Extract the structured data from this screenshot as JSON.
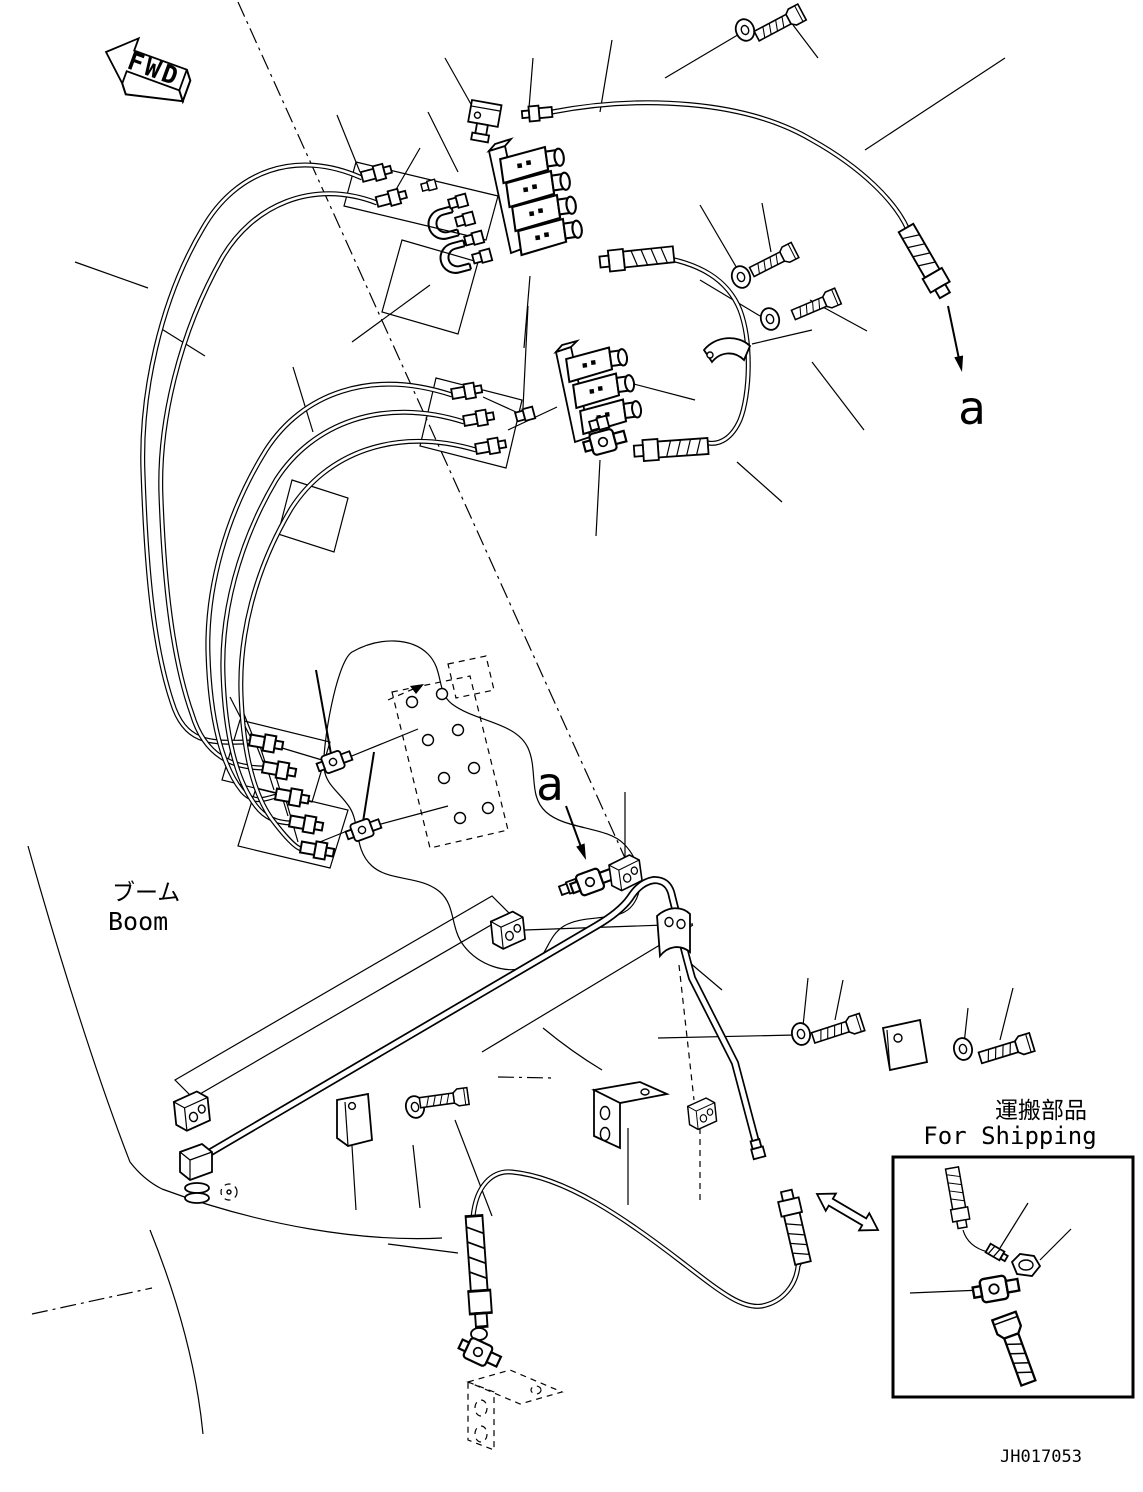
{
  "drawing": {
    "background_color": "#ffffff",
    "ink_color": "#000000",
    "fwd_label": "FWD",
    "section_marker_top": "a",
    "section_marker_mid": "a",
    "boom_label_jp": "ブーム",
    "boom_label_en": "Boom",
    "shipping_label_jp": "運搬部品",
    "shipping_label_en": "For Shipping",
    "drawing_number": "JH017053",
    "icons": {
      "fwd_arrow": "block-arrow-left-3d",
      "section_arrow": "solid-arrowhead",
      "swap_arrow": "double-headed-outline-arrow"
    }
  }
}
